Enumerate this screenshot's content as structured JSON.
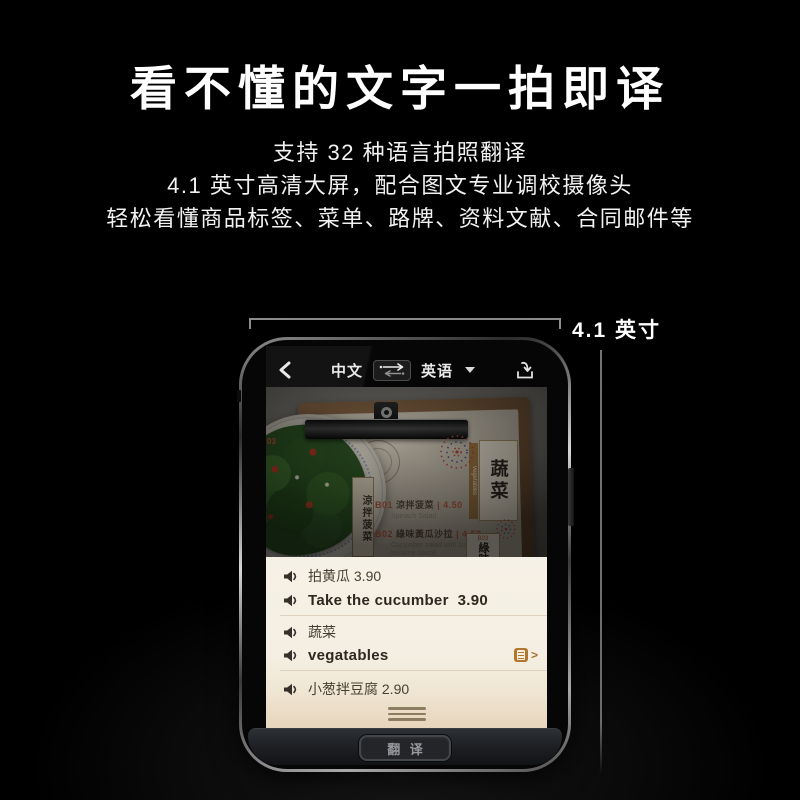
{
  "hero": {
    "headline": "看不懂的文字一拍即译",
    "line1": "支持 32 种语言拍照翻译",
    "line2": "4.1 英寸高清大屏，配合图文专业调校摄像头",
    "line3": "轻松看懂商品标签、菜单、路牌、资料文献、合同邮件等"
  },
  "dimension": {
    "label": "4.1 英寸"
  },
  "phone": {
    "topbar": {
      "source_lang": "中文",
      "target_lang": "英语"
    },
    "camera": {
      "side_code": "03",
      "plate_label": "涼拌菠菜",
      "category": {
        "strip_text": "vegetables",
        "box_text": "蔬菜"
      },
      "items": [
        {
          "code": "B01",
          "name": "涼拌菠菜",
          "price": "| 4.50",
          "en": "Spinach Salad"
        },
        {
          "code": "B02",
          "name": "綠味黃瓜沙拉",
          "price": "| 4.50",
          "en": "Cucumber salad with soy & sesame sauce"
        },
        {
          "code": "B03",
          "name": "綠味"
        }
      ]
    },
    "results": [
      {
        "text": "拍黄瓜 3.90"
      },
      {
        "text": "Take the cucumber  3.90"
      },
      {
        "text": "蔬菜"
      },
      {
        "text": "vegatables"
      },
      {
        "text": "小葱拌豆腐 2.90"
      }
    ],
    "translate_button": "翻 译"
  },
  "icons": {
    "back": "chevron-left",
    "swap": "swap-arrows",
    "caret": "caret-down",
    "import": "import-tray",
    "speaker": "speaker-sound",
    "entry": "dictionary-entry",
    "entry_chevron": ">",
    "handle": "drag-handle"
  },
  "colors": {
    "background": "#000000",
    "panel_bg": "#f5f0e4",
    "accent_amber": "#b3762f",
    "menu_price_red": "#b4543c",
    "button_text": "#97999e"
  }
}
